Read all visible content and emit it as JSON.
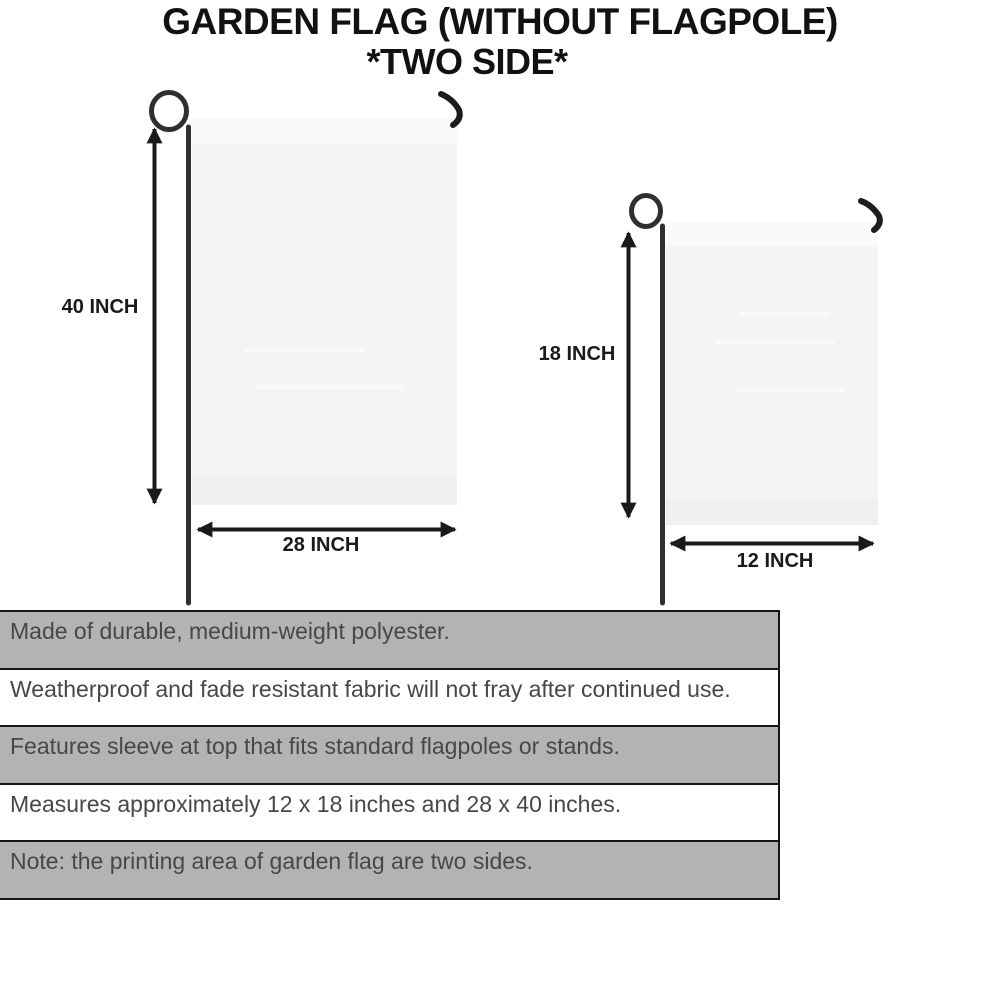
{
  "title": {
    "line1": "GARDEN FLAG (WITHOUT FLAGPOLE)",
    "line2": "*TWO SIDE*"
  },
  "diagram": {
    "large_flag": {
      "height_label": "40 INCH",
      "width_label": "28 INCH"
    },
    "small_flag": {
      "height_label": "18 INCH",
      "width_label": "12 INCH"
    }
  },
  "features": {
    "rows": [
      {
        "text": "Made of durable, medium-weight polyester.",
        "shaded": true
      },
      {
        "text": "Weatherproof and fade resistant fabric will not fray after continued use.",
        "shaded": false
      },
      {
        "text": "Features sleeve at top that fits standard flagpoles or stands.",
        "shaded": true
      },
      {
        "text": "Measures approximately 12 x 18 inches and 28 x 40 inches.",
        "shaded": false
      },
      {
        "text": "Note: the printing area of garden flag are two sides.",
        "shaded": true
      }
    ]
  },
  "colors": {
    "row_shaded": "#b4b3b3",
    "row_border": "#161616",
    "ink": "#1a1a1a",
    "pole": "#2f2f2f",
    "fabric": "#f5f4f2"
  }
}
